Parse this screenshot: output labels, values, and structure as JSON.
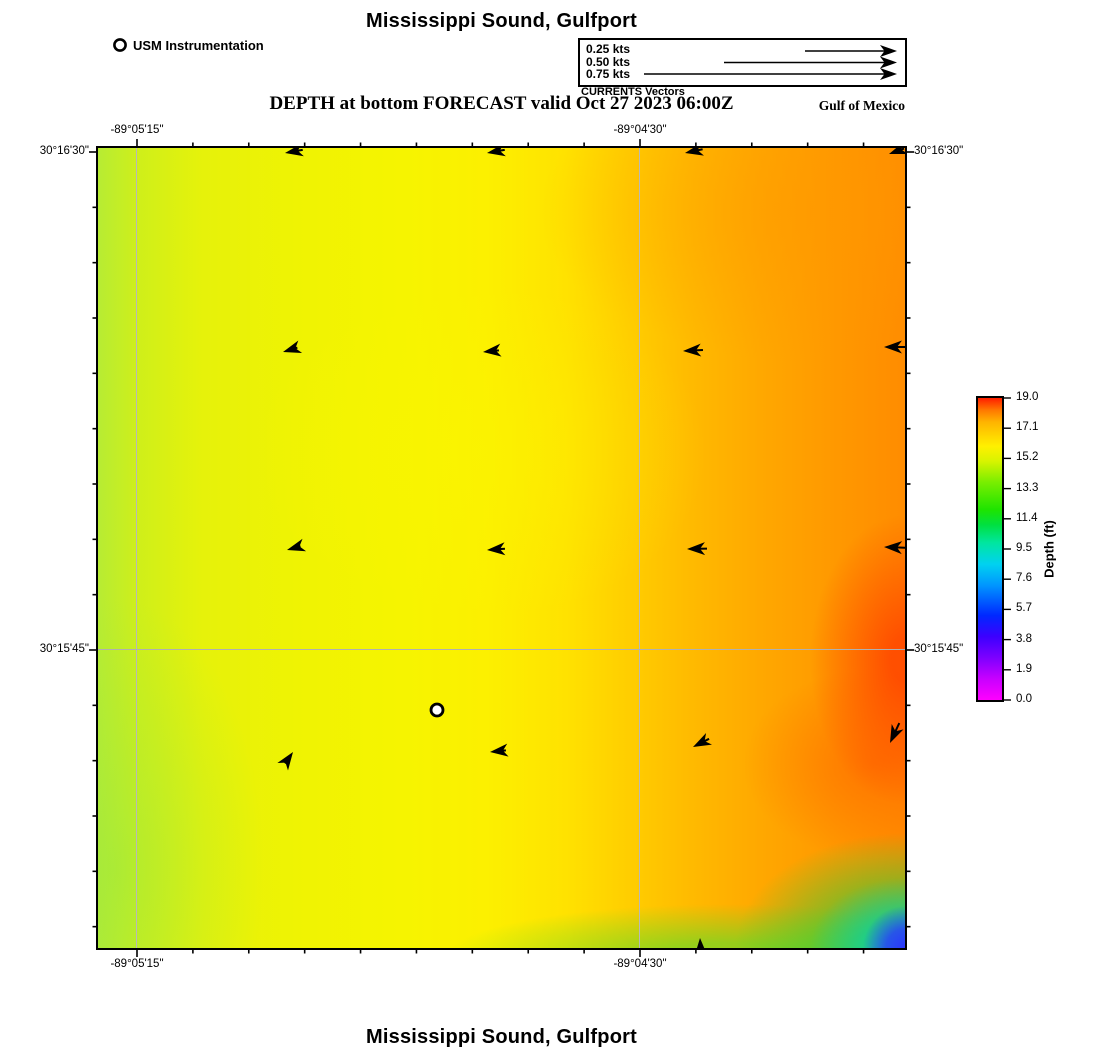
{
  "titles": {
    "top": "Mississippi Sound, Gulfport",
    "subtitle": "DEPTH at bottom FORECAST valid Oct 27 2023 06:00Z",
    "region_label": "Gulf of Mexico",
    "bottom": "Mississippi Sound, Gulfport"
  },
  "usm_legend": {
    "label": "USM Instrumentation",
    "marker": "open-circle"
  },
  "currents_legend": {
    "caption": "CURRENTS Vectors",
    "entries": [
      {
        "label": "0.25 kts",
        "tail_px": 92
      },
      {
        "label": "0.50 kts",
        "tail_px": 173
      },
      {
        "label": "0.75 kts",
        "tail_px": 253
      }
    ]
  },
  "map": {
    "axis": {
      "top": [
        {
          "text": "-89°05'15\"",
          "x": 39
        },
        {
          "text": "-89°04'30\"",
          "x": 542
        }
      ],
      "bottom": [
        {
          "text": "-89°05'15\"",
          "x": 39
        },
        {
          "text": "-89°04'30\"",
          "x": 542
        }
      ],
      "left": [
        {
          "text": "30°16'30\"",
          "y": 4
        },
        {
          "text": "30°15'45\"",
          "y": 502
        }
      ],
      "right": [
        {
          "text": "30°16'30\"",
          "y": 4
        },
        {
          "text": "30°15'45\"",
          "y": 502
        }
      ]
    },
    "gridlines": {
      "vertical_x": [
        39,
        542
      ],
      "horizontal_y": [
        502
      ]
    },
    "station_marker": {
      "x": 339,
      "y": 562
    },
    "arrows": [
      {
        "x": 187,
        "y": 5,
        "dir": 190,
        "tail": 18
      },
      {
        "x": 389,
        "y": 5,
        "dir": 190,
        "tail": 18
      },
      {
        "x": 587,
        "y": 5,
        "dir": 192,
        "tail": 18
      },
      {
        "x": 791,
        "y": 6,
        "dir": 200,
        "tail": 16
      },
      {
        "x": 185,
        "y": 204,
        "dir": 197,
        "tail": 15
      },
      {
        "x": 385,
        "y": 204,
        "dir": 186,
        "tail": 16
      },
      {
        "x": 585,
        "y": 203,
        "dir": 183,
        "tail": 20
      },
      {
        "x": 786,
        "y": 199,
        "dir": 180,
        "tail": 26
      },
      {
        "x": 189,
        "y": 402,
        "dir": 196,
        "tail": 14
      },
      {
        "x": 389,
        "y": 402,
        "dir": 184,
        "tail": 18
      },
      {
        "x": 589,
        "y": 401,
        "dir": 181,
        "tail": 20
      },
      {
        "x": 786,
        "y": 399,
        "dir": 178,
        "tail": 28
      },
      {
        "x": 195,
        "y": 604,
        "dir": 55,
        "tail": 14
      },
      {
        "x": 392,
        "y": 604,
        "dir": 186,
        "tail": 16
      },
      {
        "x": 595,
        "y": 599,
        "dir": 207,
        "tail": 18
      },
      {
        "x": 792,
        "y": 595,
        "dir": 245,
        "tail": 22
      },
      {
        "x": 602,
        "y": 790,
        "dir": 93,
        "tail": 20
      }
    ]
  },
  "colorbar": {
    "label": "Depth (ft)",
    "tick_labels_top_to_bottom": [
      "19.0",
      "17.1",
      "15.2",
      "13.3",
      "11.4",
      "9.5",
      "7.6",
      "5.7",
      "3.8",
      "1.9",
      "0.0"
    ]
  },
  "chart_data": {
    "type": "heatmap",
    "title": "Mississippi Sound, Gulfport",
    "subtitle": "DEPTH at bottom FORECAST valid Oct 27 2023 06:00Z",
    "x_tick_labels": [
      "-89°05'15\"",
      "-89°04'30\""
    ],
    "y_tick_labels": [
      "30°16'30\"",
      "30°15'45\""
    ],
    "colorbar": {
      "label": "Depth (ft)",
      "range": [
        0.0,
        19.0
      ],
      "ticks": [
        0.0,
        1.9,
        3.8,
        5.7,
        7.6,
        9.5,
        11.4,
        13.3,
        15.2,
        17.1,
        19.0
      ],
      "colormap": "magenta-blue-cyan-green-yellow-orange-red"
    },
    "depth_grid_ft": {
      "note": "approximate depths sampled on a 5x5 grid, rows north to south, cols west to east",
      "values": [
        [
          14.8,
          15.2,
          15.9,
          16.8,
          17.2
        ],
        [
          14.9,
          15.2,
          16.1,
          17.0,
          17.5
        ],
        [
          14.9,
          15.3,
          16.3,
          17.3,
          18.0
        ],
        [
          14.7,
          15.4,
          16.5,
          17.5,
          18.6
        ],
        [
          14.4,
          15.1,
          15.6,
          13.0,
          5.5
        ]
      ]
    },
    "current_vectors": {
      "unit": "kts",
      "reference_speeds": [
        0.25,
        0.5,
        0.75
      ],
      "approx_field_speed_kts": 0.05,
      "pattern": "mostly westward; northeastward at southwest grid point; northward at south edge"
    },
    "station": {
      "name": "USM Instrumentation",
      "marker": "open-circle"
    },
    "annotations": [
      "Gulf of Mexico",
      "CURRENTS Vectors"
    ]
  }
}
